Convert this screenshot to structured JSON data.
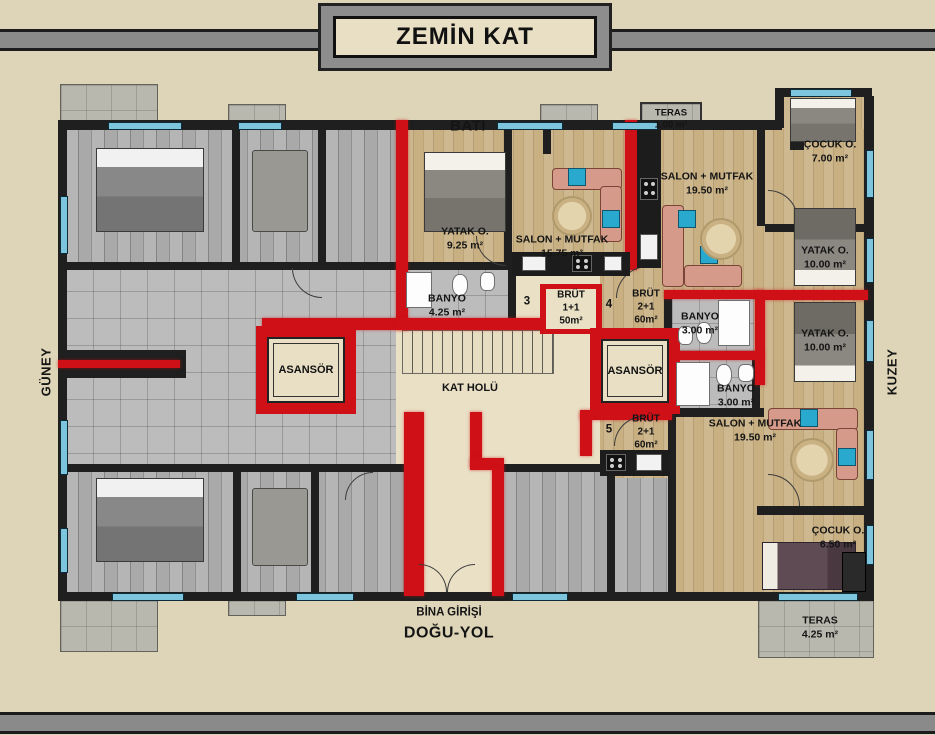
{
  "header": {
    "title": "ZEMİN KAT"
  },
  "compass": {
    "top": "BATI",
    "left": "GÜNEY",
    "right": "KUZEY"
  },
  "road": {
    "entrance": "BİNA GİRİŞİ",
    "road": "DOĞU-YOL"
  },
  "hall": {
    "label": "KAT HOLÜ"
  },
  "elevators": {
    "left": "ASANSÖR",
    "right": "ASANSÖR"
  },
  "terraces": {
    "t1": {
      "name": "TERAS",
      "area": "1.00 m²"
    },
    "t2": {
      "name": "TERAS",
      "area": "4.25 m²"
    }
  },
  "units": {
    "u3": {
      "number": "3",
      "l1": "BRÜT",
      "l2": "1+1",
      "l3": "50m²"
    },
    "u4": {
      "number": "4",
      "l1": "BRÜT",
      "l2": "2+1",
      "l3": "60m²"
    },
    "u5": {
      "number": "5",
      "l1": "BRÜT",
      "l2": "2+1",
      "l3": "60m²"
    }
  },
  "rooms": {
    "cocuk7": {
      "name": "ÇOCUK O.",
      "area": "7.00 m²"
    },
    "yatak925": {
      "name": "YATAK O.",
      "area": "9.25 m²"
    },
    "salon1575": {
      "name": "SALON + MUTFAK",
      "area": "15.75 m²"
    },
    "salon195a": {
      "name": "SALON + MUTFAK",
      "area": "19.50 m²"
    },
    "banyo425": {
      "name": "BANYO",
      "area": "4.25 m²"
    },
    "banyo3a": {
      "name": "BANYO",
      "area": "3.00 m²"
    },
    "banyo3b": {
      "name": "BANYO",
      "area": "3.00 m²"
    },
    "yatak10a": {
      "name": "YATAK O.",
      "area": "10.00 m²"
    },
    "yatak10b": {
      "name": "YATAK O.",
      "area": "10.00 m²"
    },
    "salon195b": {
      "name": "SALON + MUTFAK",
      "area": "19.50 m²"
    },
    "cocuk650": {
      "name": "ÇOCUK O.",
      "area": "6.50 m²"
    }
  },
  "colors": {
    "wall_red": "#cf1117",
    "wall_black": "#1f1f1f",
    "window_blue": "#7cc5dd",
    "paper": "#ded5b8"
  }
}
